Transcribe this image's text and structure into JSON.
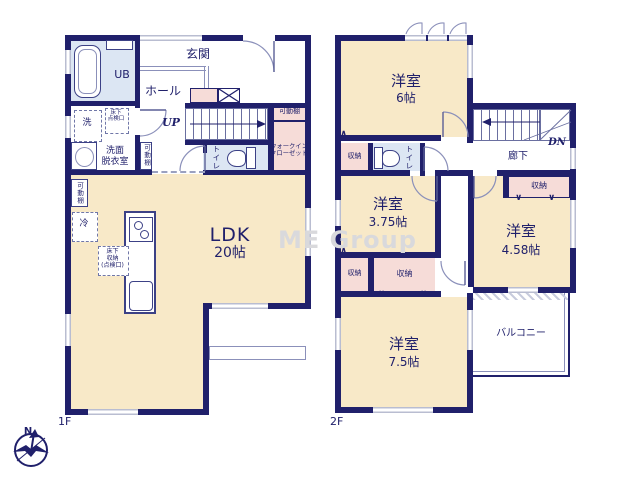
{
  "watermark": "ME Group",
  "compass": {
    "north_label": "N"
  },
  "colors": {
    "wall_navy": "#20206b",
    "room_cream": "#f8e9c8",
    "wet_area_blue": "#dce6f3",
    "closet_pink": "#f6dcd8",
    "window_gray": "#b9bdd1",
    "text_navy": "#20206b",
    "watermark_gray": "#d9d9dc"
  },
  "floor1": {
    "floor_label": "1F",
    "entrance": "玄関",
    "hall": "ホール",
    "unit_bath": "UB",
    "washer": "洗",
    "underfloor_access_l1": "床下",
    "underfloor_access_l2": "点検口",
    "washroom_l1": "洗面",
    "washroom_l2": "脱衣室",
    "shelf": "可動棚",
    "toilet": "トイレ",
    "stairs_up": "UP",
    "wic_l1": "ウォークイン",
    "wic_l2": "クローゼット",
    "ldk_name": "LDK",
    "ldk_size": "20帖",
    "fridge": "冷",
    "underfloor_storage_l1": "床下",
    "underfloor_storage_l2": "収納",
    "underfloor_storage_l3": "(点検口)"
  },
  "floor2": {
    "floor_label": "2F",
    "room6_name": "洋室",
    "room6_size": "6帖",
    "storage": "収納",
    "toilet": "トイレ",
    "stairs_down": "DN",
    "corridor": "廊下",
    "room375_name": "洋室",
    "room375_size": "3.75帖",
    "room458_name": "洋室",
    "room458_size": "4.58帖",
    "balcony": "バルコニー",
    "room75_name": "洋室",
    "room75_size": "7.5帖"
  }
}
